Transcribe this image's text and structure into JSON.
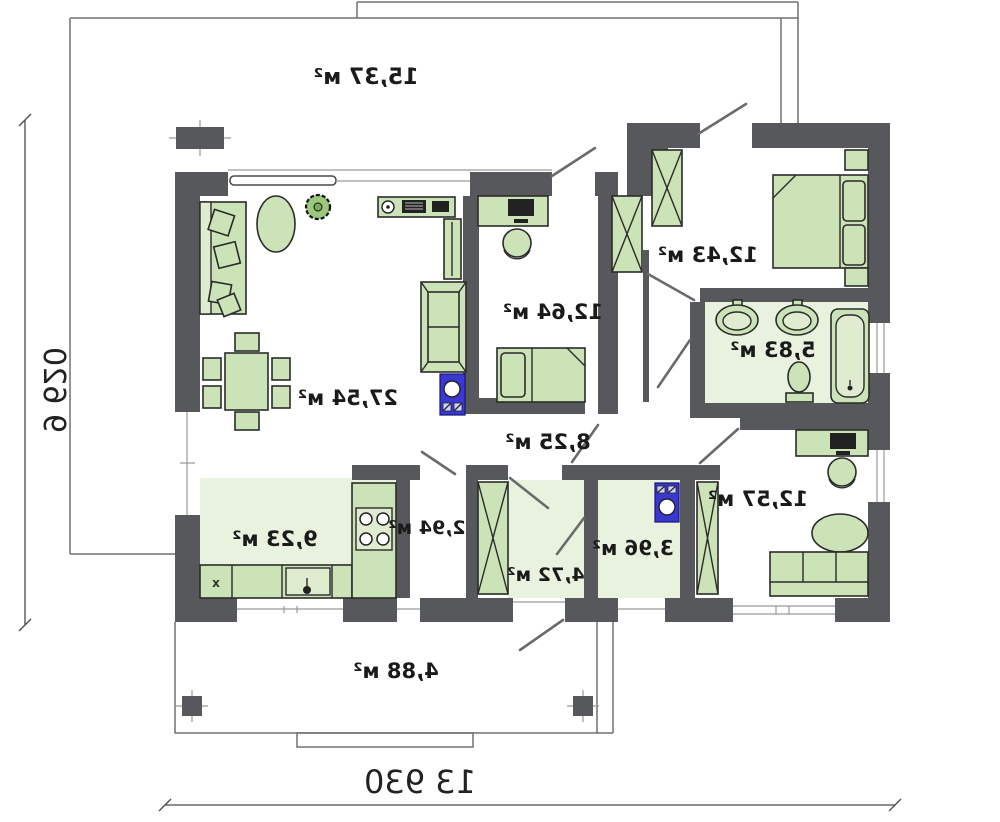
{
  "plan": {
    "type": "floor-plan",
    "mirrored": true,
    "rooms": [
      {
        "name": "terrace",
        "area_label": "15,37 м²"
      },
      {
        "name": "living-dining",
        "area_label": "27,54 м²"
      },
      {
        "name": "bedroom-middle",
        "area_label": "12,64 м²"
      },
      {
        "name": "bedroom-master",
        "area_label": "12,43 м²"
      },
      {
        "name": "bathroom",
        "area_label": "5,83 м²"
      },
      {
        "name": "corridor",
        "area_label": "8,25 м²"
      },
      {
        "name": "kitchen",
        "area_label": "9,23 м²"
      },
      {
        "name": "pantry",
        "area_label": "2,94 м²"
      },
      {
        "name": "entrance-hall",
        "area_label": "4,72 м²"
      },
      {
        "name": "laundry-wc",
        "area_label": "3,96 м²"
      },
      {
        "name": "bedroom-right",
        "area_label": "12,57 м²"
      },
      {
        "name": "porch",
        "area_label": "4,88 м²"
      }
    ],
    "dimensions": {
      "overall_width": "13 930",
      "overall_depth": "9 620"
    },
    "kitchen_cabinet_mark": "x",
    "colors": {
      "wall": "#57585c",
      "furniture_green": "#cbe3b6",
      "floor_tint": "#e9f2de",
      "appliance_blue": "#3a38d1",
      "outline_gray": "#707070",
      "text": "#1a1a1a"
    }
  }
}
